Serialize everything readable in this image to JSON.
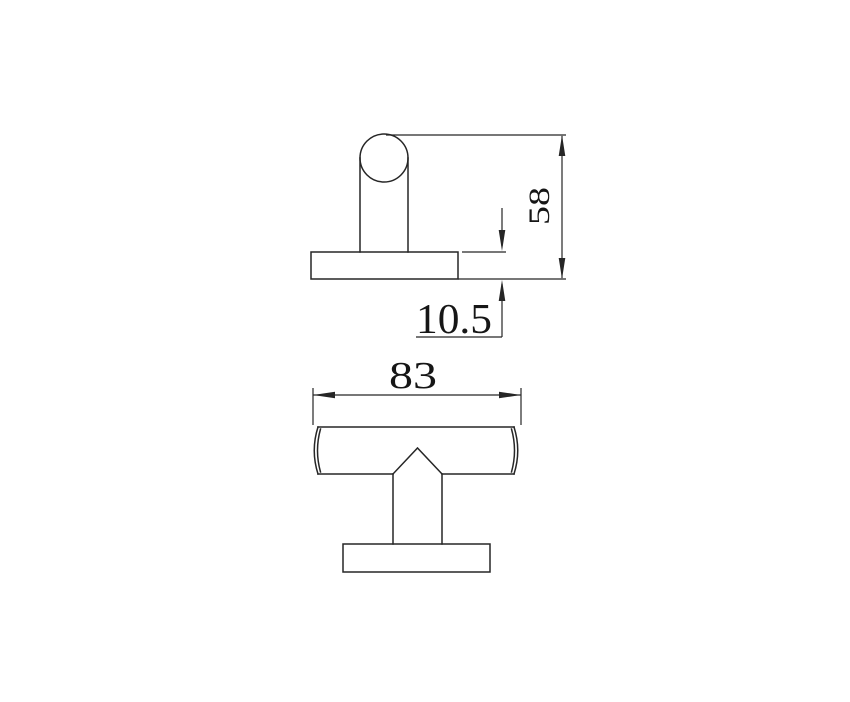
{
  "drawing": {
    "type": "technical-dimension-drawing",
    "subject": "t-bar-knob-two-views",
    "background_color": "#ffffff",
    "line_color": "#262626",
    "text_color": "#161616",
    "views": {
      "side_view": {
        "name": "side-view-top",
        "parts": [
          "knob-cap-circle",
          "stem",
          "base-plate"
        ]
      },
      "front_view": {
        "name": "front-view-bottom",
        "parts": [
          "handle-bar",
          "cone-neck",
          "stem",
          "base-plate"
        ]
      }
    },
    "dimensions": {
      "overall_height": {
        "value": "58",
        "orientation": "vertical"
      },
      "base_thickness": {
        "value": "10.5",
        "orientation": "leader"
      },
      "overall_width": {
        "value": "83",
        "orientation": "horizontal"
      }
    }
  }
}
